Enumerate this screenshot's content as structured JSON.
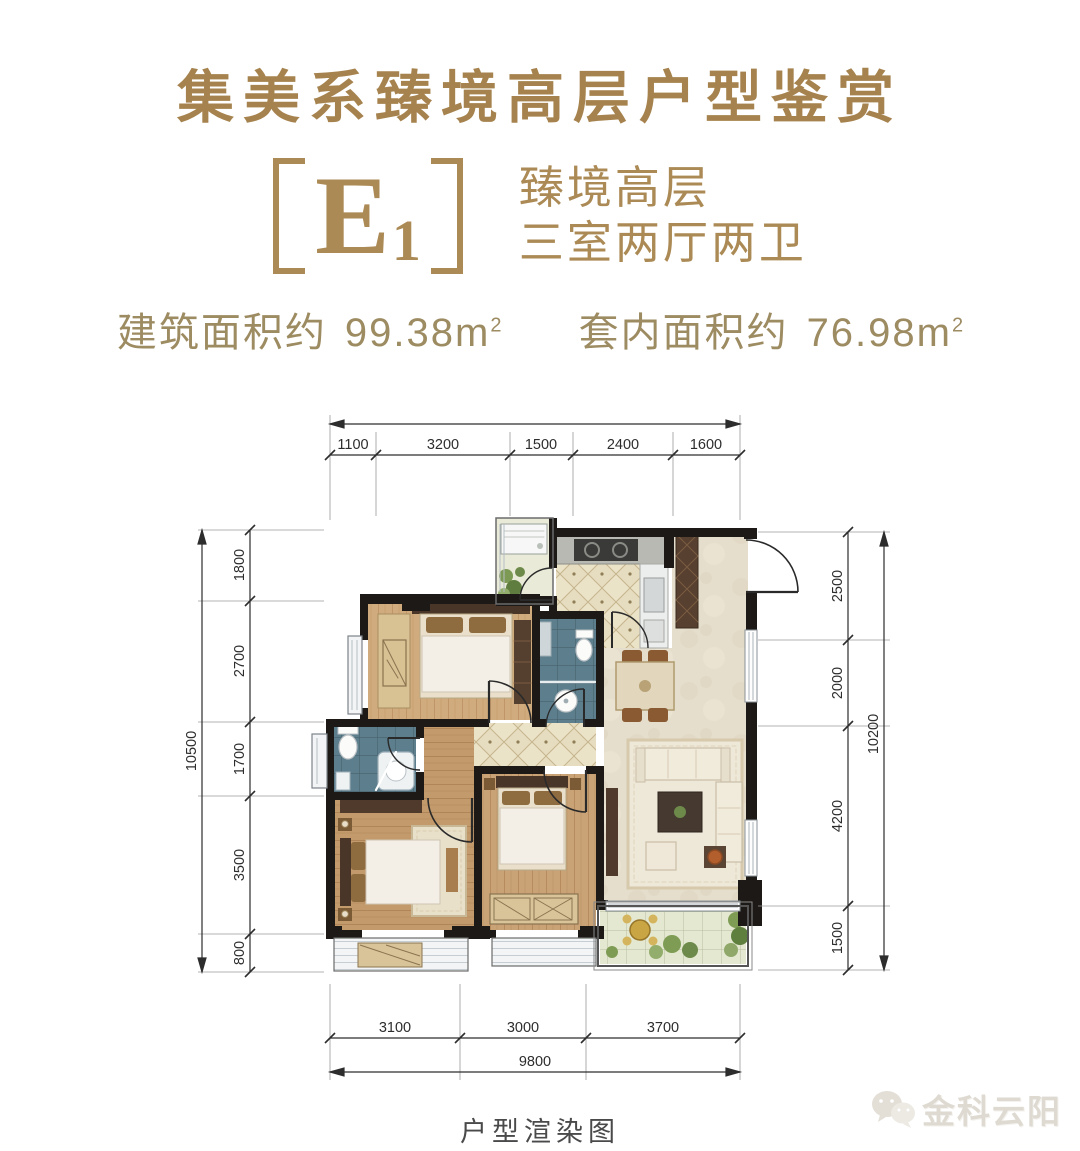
{
  "header": {
    "title": "集美系臻境高层户型鉴赏",
    "unit": {
      "code": "E",
      "sub": "1"
    },
    "subtitle": {
      "line1": "臻境高层",
      "line2": "三室两厅两卫"
    },
    "areas": {
      "build_label": "建筑面积约",
      "build_value": "99.38",
      "inner_label": "套内面积约",
      "inner_value": "76.98",
      "unit": "m",
      "sup": "2"
    }
  },
  "plan": {
    "dims": {
      "top": [
        "1100",
        "3200",
        "1500",
        "2400",
        "1600"
      ],
      "left": [
        "1800",
        "2700",
        "1700",
        "3500",
        "800"
      ],
      "left_total": "10500",
      "right": [
        "2500",
        "2000",
        "4200",
        "1500"
      ],
      "right_total": "10200",
      "bottom": [
        "3100",
        "3000",
        "3700"
      ],
      "bottom_total": "9800"
    }
  },
  "footer": {
    "caption": "户型渲染图"
  },
  "watermark": {
    "label": "金科云阳"
  },
  "colors": {
    "accent_gold": "#a6834e",
    "subtitle_gold": "#ab8a55",
    "area_gold": "#9d8b62",
    "dim_ink": "#2d2d2d",
    "wall_ink": "#1c1916",
    "caption_ink": "#4a4a4a"
  }
}
